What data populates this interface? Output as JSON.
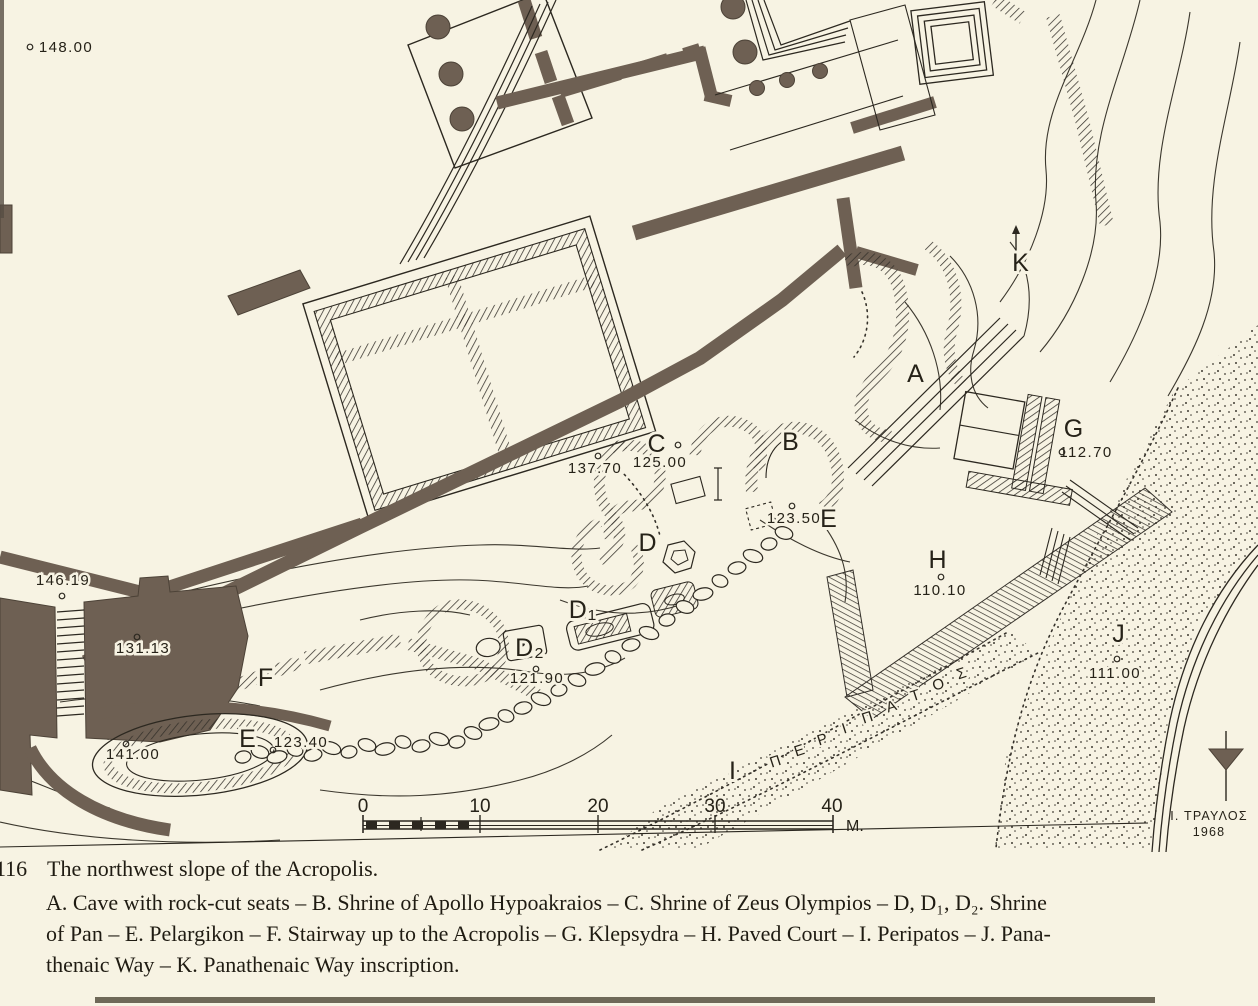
{
  "figure": {
    "number": "116",
    "title": "The northwest slope of the Acropolis.",
    "legend_lines": [
      "A. Cave with rock-cut seats – B. Shrine of Apollo Hypoakraios – C. Shrine of Zeus Olympios – D, D₁, D₂. Shrine",
      "of Pan – E. Pelargikon – F. Stairway up to the Acropolis – G. Klepsydra – H. Paved Court – I. Peripatos – J. Pana-",
      "thenaic Way – K. Panathenaic Way inscription."
    ]
  },
  "map": {
    "letters": [
      {
        "id": "A",
        "text": "A",
        "x": 916,
        "y": 382
      },
      {
        "id": "B",
        "text": "B",
        "x": 791,
        "y": 450
      },
      {
        "id": "C",
        "text": "C",
        "x": 657,
        "y": 452
      },
      {
        "id": "D",
        "text": "D",
        "x": 648,
        "y": 551
      },
      {
        "id": "D1",
        "text": "D₁",
        "x": 583,
        "y": 618
      },
      {
        "id": "D2",
        "text": "D₂",
        "x": 530,
        "y": 656
      },
      {
        "id": "E-upper",
        "text": "E",
        "x": 829,
        "y": 527
      },
      {
        "id": "E-lower",
        "text": "E",
        "x": 248,
        "y": 747
      },
      {
        "id": "F",
        "text": "F",
        "x": 266,
        "y": 686
      },
      {
        "id": "G",
        "text": "G",
        "x": 1074,
        "y": 437
      },
      {
        "id": "H",
        "text": "H",
        "x": 938,
        "y": 568
      },
      {
        "id": "I",
        "text": "Ι",
        "x": 733,
        "y": 779
      },
      {
        "id": "J",
        "text": "J",
        "x": 1119,
        "y": 642
      },
      {
        "id": "K",
        "text": "K",
        "x": 1021,
        "y": 271
      }
    ],
    "elevations": [
      {
        "text": "148.00",
        "x": 66,
        "y": 52,
        "mx": 30,
        "my": 47
      },
      {
        "text": "146.19",
        "x": 63,
        "y": 585,
        "mx": 62,
        "my": 596
      },
      {
        "text": "131.13",
        "x": 143,
        "y": 653,
        "mx": 137,
        "my": 637
      },
      {
        "text": "141.00",
        "x": 133,
        "y": 759,
        "mx": 126,
        "my": 744
      },
      {
        "text": "123.40",
        "x": 301,
        "y": 747,
        "mx": 273,
        "my": 750
      },
      {
        "text": "121.90",
        "x": 537,
        "y": 683,
        "mx": 536,
        "my": 669
      },
      {
        "text": "137.70",
        "x": 595,
        "y": 473,
        "mx": 598,
        "my": 456
      },
      {
        "text": "125.00",
        "x": 660,
        "y": 467,
        "mx": 678,
        "my": 445
      },
      {
        "text": "123.50",
        "x": 794,
        "y": 523,
        "mx": 792,
        "my": 506
      },
      {
        "text": "112.70",
        "x": 1086,
        "y": 457,
        "mx": 1062,
        "my": 452
      },
      {
        "text": "110.10",
        "x": 940,
        "y": 595,
        "mx": 941,
        "my": 577
      },
      {
        "text": "111.00",
        "x": 1115,
        "y": 678,
        "mx": 1117,
        "my": 659
      }
    ],
    "peripatos": {
      "letters": [
        {
          "ch": "Π",
          "x": 777,
          "y": 766
        },
        {
          "ch": "Ε",
          "x": 801,
          "y": 755
        },
        {
          "ch": "Ρ",
          "x": 824,
          "y": 744
        },
        {
          "ch": "Ι",
          "x": 846,
          "y": 733
        },
        {
          "ch": "Π",
          "x": 869,
          "y": 722
        },
        {
          "ch": "Α",
          "x": 893,
          "y": 711
        },
        {
          "ch": "Τ",
          "x": 917,
          "y": 700
        },
        {
          "ch": "Ο",
          "x": 940,
          "y": 689
        },
        {
          "ch": "Σ",
          "x": 963,
          "y": 678
        }
      ]
    },
    "scale": {
      "ticks": [
        {
          "label": "0",
          "x": 363
        },
        {
          "label": "10",
          "x": 480
        },
        {
          "label": "20",
          "x": 598
        },
        {
          "label": "30",
          "x": 715
        },
        {
          "label": "40",
          "x": 832
        }
      ],
      "unit": "M."
    },
    "credit": {
      "name": "Ι. ΤΡΑΥΛΟΣ",
      "year": "1968"
    },
    "colors": {
      "paper": "#f7f3e3",
      "ink": "#2c2820",
      "wall": "#6e6053"
    }
  }
}
